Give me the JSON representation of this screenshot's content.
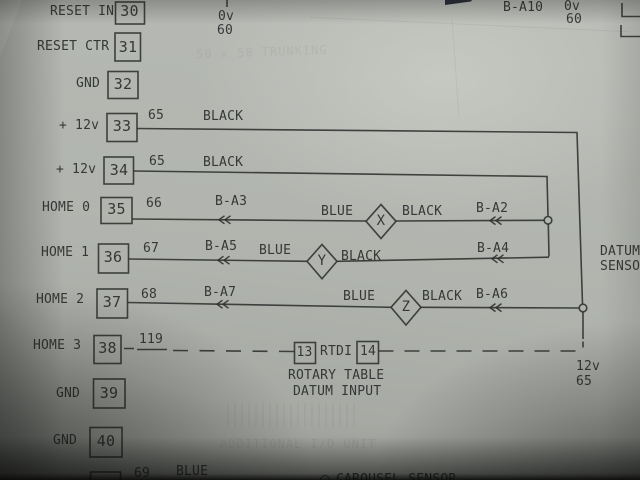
{
  "top": {
    "stub_0v": "0v",
    "stub_wire": "60",
    "b_a10": "B-A10",
    "right_0v": "0v",
    "right_wire": "60"
  },
  "terminals": [
    {
      "label": "RESET IN",
      "num": "30"
    },
    {
      "label": "RESET CTR",
      "num": "31"
    },
    {
      "label": "GND",
      "num": "32"
    },
    {
      "label": "+ 12v",
      "num": "33"
    },
    {
      "label": "+ 12v",
      "num": "34"
    },
    {
      "label": "HOME 0",
      "num": "35"
    },
    {
      "label": "HOME 1",
      "num": "36"
    },
    {
      "label": "HOME 2",
      "num": "37"
    },
    {
      "label": "HOME 3",
      "num": "38"
    },
    {
      "label": "GND",
      "num": "39"
    },
    {
      "label": "GND",
      "num": "40"
    }
  ],
  "wires": {
    "w33": {
      "num": "65",
      "color": "BLACK"
    },
    "w34": {
      "num": "65",
      "color": "BLACK"
    },
    "w35": {
      "num": "66",
      "near_tag": "B-A3",
      "blue": "BLUE",
      "sensor": "X",
      "black": "BLACK",
      "far_tag": "B-A2"
    },
    "w36": {
      "num": "67",
      "near_tag": "B-A5",
      "blue": "BLUE",
      "sensor": "Y",
      "black": "BLACK",
      "far_tag": "B-A4"
    },
    "w37": {
      "num": "68",
      "near_tag": "B-A7",
      "blue": "BLUE",
      "sensor": "Z",
      "black": "BLACK",
      "far_tag": "B-A6"
    },
    "w38": {
      "num": "119"
    },
    "w41": {
      "num": "69",
      "color": "BLUE"
    }
  },
  "rtdi": {
    "box13": "13",
    "label": "RTDI",
    "box14": "14",
    "caption_line1": "ROTARY TABLE",
    "caption_line2": "DATUM INPUT",
    "supply_voltage": "12v",
    "supply_wire": "65"
  },
  "notes": {
    "datum_line1": "DATUM",
    "datum_line2": "SENSOR",
    "carousel": "CAROUSEL SENSOR"
  },
  "ghost": {
    "trunking": "50 x 50 TRUNKING",
    "additional": "ADDITIONAL I/O UNIT"
  },
  "colors": {
    "paper": "#b1b4ae",
    "ink": "#2a2e2c",
    "wedge": "#2a2d38"
  }
}
